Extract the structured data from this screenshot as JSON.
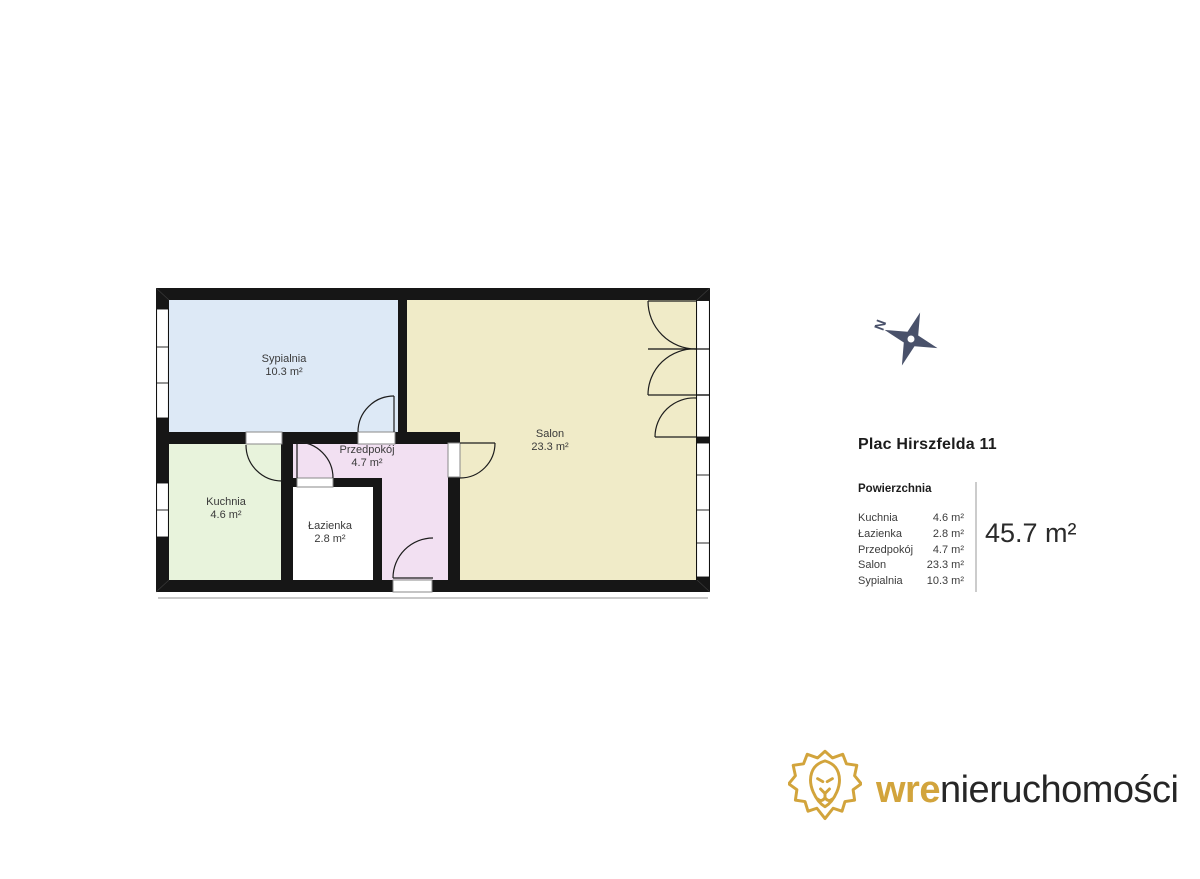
{
  "floor_plan": {
    "rooms": [
      {
        "id": "sypialnia",
        "label": "Sypialnia",
        "area": "10.3 m²",
        "color": "#dde9f6"
      },
      {
        "id": "salon",
        "label": "Salon",
        "area": "23.3 m²",
        "color": "#f0ebc8"
      },
      {
        "id": "kuchnia",
        "label": "Kuchnia",
        "area": "4.6 m²",
        "color": "#e8f3dc"
      },
      {
        "id": "lazienka",
        "label": "Łazienka",
        "area": "2.8 m²",
        "color": "#ffffff"
      },
      {
        "id": "przedpokoj",
        "label": "Przedpokój",
        "area": "4.7 m²",
        "color": "#f2e0f2"
      }
    ],
    "wall_color": "#161616",
    "compass": {
      "north_label": "N",
      "color": "#49516a"
    }
  },
  "info_panel": {
    "title": "Plac Hirszfelda 11",
    "table_header": "Powierzchnia",
    "rows": [
      {
        "label": "Kuchnia",
        "value": "4.6 m²"
      },
      {
        "label": "Łazienka",
        "value": "2.8 m²"
      },
      {
        "label": "Przedpokój",
        "value": "4.7 m²"
      },
      {
        "label": "Salon",
        "value": "23.3 m²"
      },
      {
        "label": "Sypialnia",
        "value": "10.3 m²"
      }
    ],
    "total_area": "45.7 m²"
  },
  "branding": {
    "logo_bold": "wre",
    "logo_rest": "nieruchomości",
    "accent_color": "#d2a43c"
  }
}
